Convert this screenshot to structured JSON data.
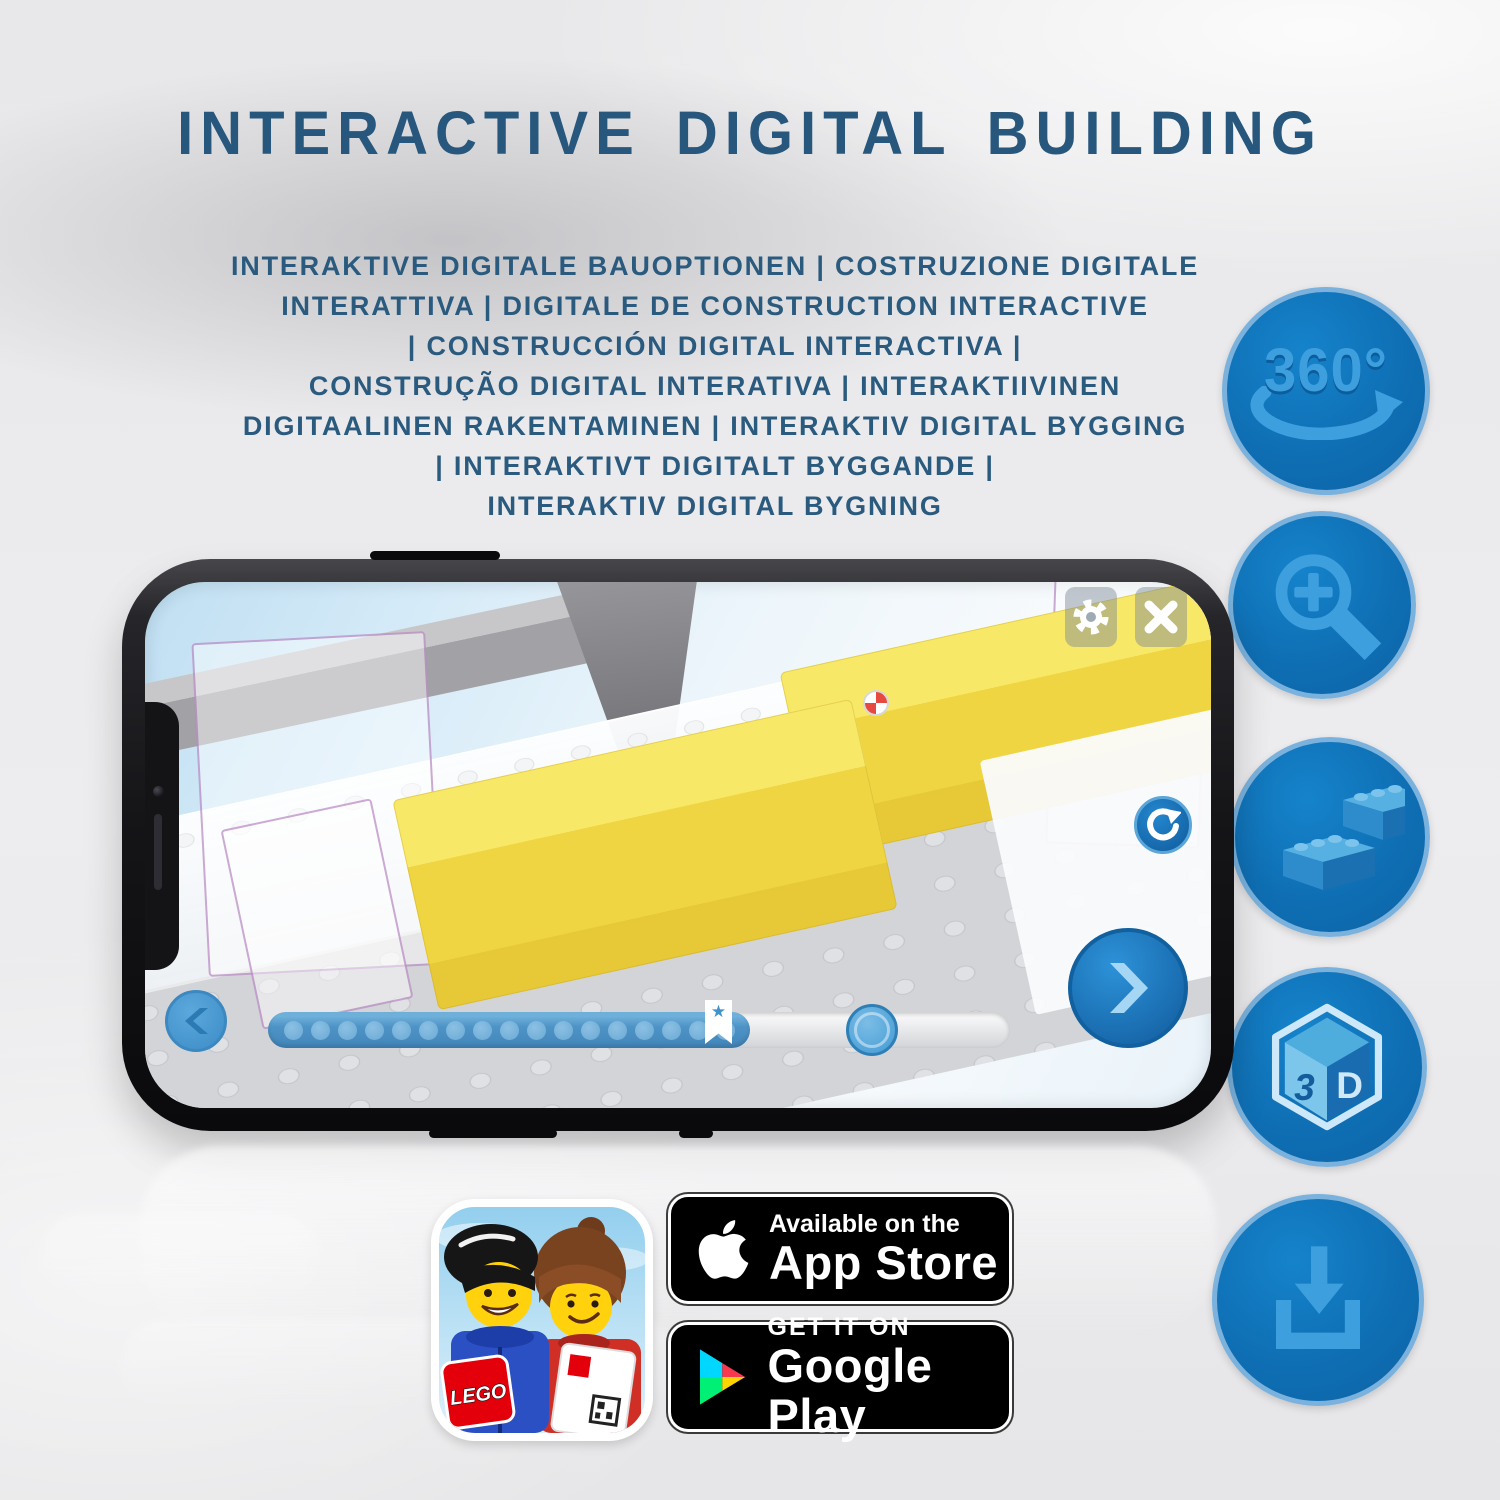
{
  "header": {
    "title": "INTERACTIVE DIGITAL BUILDING",
    "subtitle_lines": [
      "INTERAKTIVE DIGITALE BAUOPTIONEN | COSTRUZIONE DIGITALE",
      "INTERATTIVA | DIGITALE DE CONSTRUCTION INTERACTIVE",
      "| CONSTRUCCIÓN DIGITAL INTERACTIVA |",
      "CONSTRUÇÃO DIGITAL INTERATIVA | INTERAKTIIVINEN",
      "DIGITAALINEN RAKENTAMINEN | INTERAKTIV DIGITAL BYGGING",
      "| INTERAKTIVT DIGITALT BYGGANDE |",
      "INTERAKTIV DIGITAL BYGNING"
    ]
  },
  "feature_icons": {
    "rotation": {
      "label": "360°"
    },
    "three_d": {
      "left_letter": "3",
      "right_letter": "D"
    }
  },
  "phone": {
    "progress": {
      "dot_count": 17,
      "star_symbol": "★"
    }
  },
  "badges": {
    "lego_app": {
      "logo_text": "LEGO"
    },
    "app_store": {
      "line1": "Available on the",
      "line2": "App Store"
    },
    "google_play": {
      "line1": "GET IT ON",
      "line2": "Google Play"
    }
  },
  "colors": {
    "title_blue": "#27577c",
    "icon_circle_blue": "#0f6fb4",
    "icon_glyph_blue": "#3d9fdd",
    "yellow_brick": "#f0d542",
    "badge_black": "#000000"
  }
}
